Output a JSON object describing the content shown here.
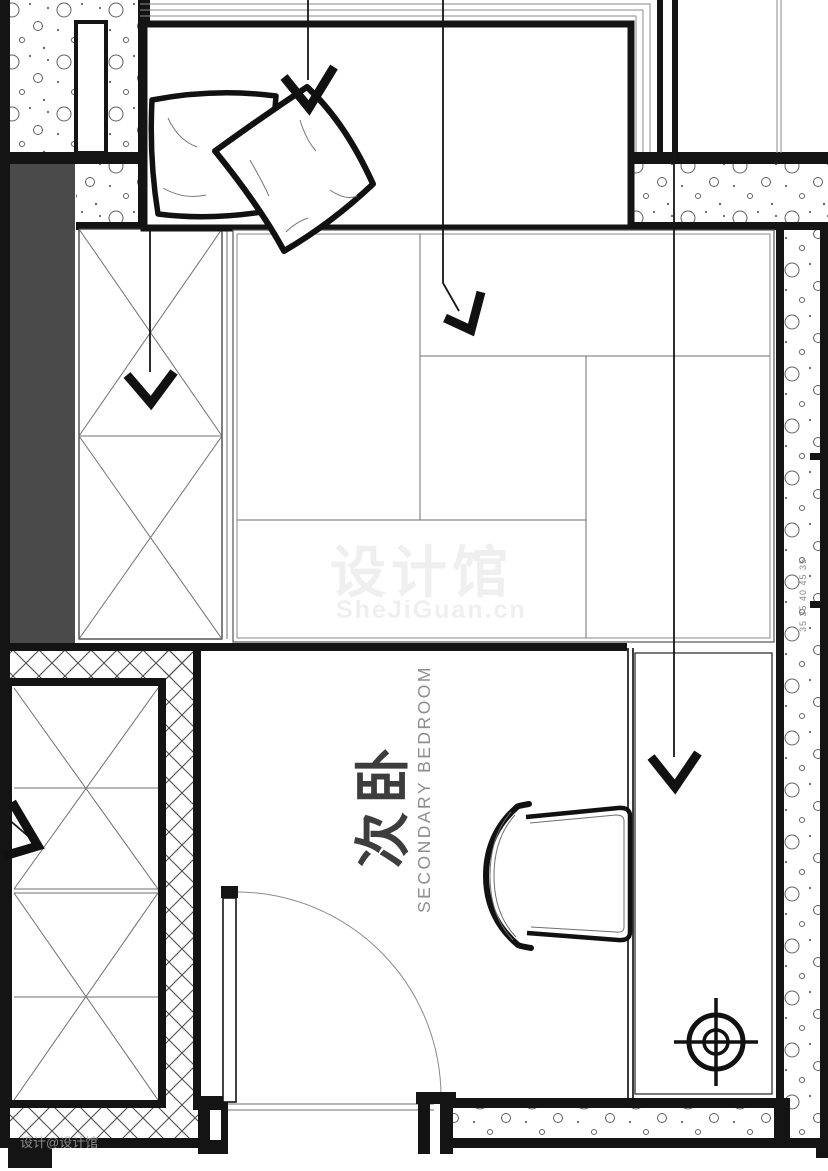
{
  "page": {
    "width": 828,
    "height": 1171,
    "background": "#ffffff",
    "kind": "interior floor plan"
  },
  "room": {
    "name_cn": "次卧",
    "name_en": "SECONDARY BEDROOM"
  },
  "annotations": {
    "wall_note": "35 35 40 45 35"
  },
  "watermark": {
    "title": "设计馆",
    "url": "SheJiGuan.cn",
    "corner": "设计@设计馆"
  },
  "colors": {
    "line": "#141414",
    "thin_line": "#6f6f6f",
    "dark_wall_fill": "#4a4a4a",
    "hatch_line": "#4d4d4d",
    "watermark_gray": "#efefef",
    "label_cn_color": "#3d3d3d",
    "label_en_color": "#8e8e8e",
    "annotation_color": "#888888"
  }
}
